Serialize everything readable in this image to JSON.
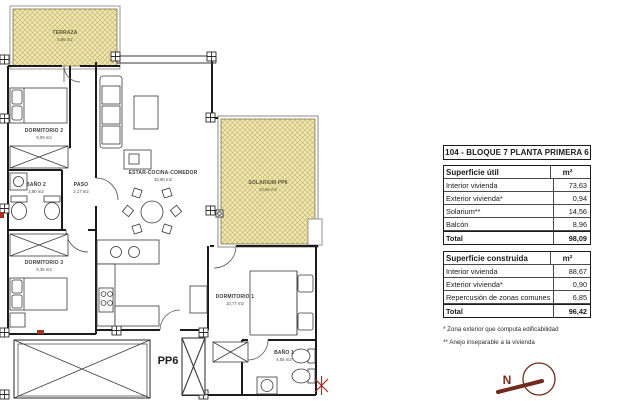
{
  "plan": {
    "rooms": {
      "terraza": {
        "name": "TERRAZA",
        "area": "8,96 m2"
      },
      "dormitorio2": {
        "name": "DORMITORIO 2",
        "area": "9,09 m2"
      },
      "bano2": {
        "name": "BAÑO 2",
        "area": "3,80 m2"
      },
      "paso": {
        "name": "PASO",
        "area": "2,17 m2"
      },
      "estar": {
        "name": "ESTAR-COCINA-COMEDOR",
        "area": "33,90 m2"
      },
      "solarium": {
        "name": "SOLARIUM PP6",
        "area": "14,56 m2"
      },
      "dormitorio3": {
        "name": "DORMITORIO 3",
        "area": "9,35 m2"
      },
      "dormitorio1": {
        "name": "DORMITORIO 1",
        "area": "10,77 m2"
      },
      "bano1": {
        "name": "BAÑO 1",
        "area": "4,55 m2"
      }
    },
    "unit_label": "PP6",
    "compass_north": "N"
  },
  "info": {
    "title": "104 - BLOQUE 7 PLANTA PRIMERA 6",
    "util": {
      "header": "Superficie útil",
      "unit": "m²",
      "rows": [
        [
          "Interior vivienda",
          "73,63"
        ],
        [
          "Exterior vivienda*",
          "0,94"
        ],
        [
          "Solarium**",
          "14,56"
        ],
        [
          "Balcón",
          "8,96"
        ]
      ],
      "total_label": "Total",
      "total_value": "98,09"
    },
    "construida": {
      "header": "Superficie construida",
      "unit": "m²",
      "rows": [
        [
          "Interior vivienda",
          "88,67"
        ],
        [
          "Exterior vivienda*",
          "0,90"
        ],
        [
          "Repercusión de zonas comunes",
          "6,85"
        ]
      ],
      "total_label": "Total",
      "total_value": "96,42"
    },
    "footnotes": [
      "* Zona exterior que computa edificabilidad",
      "** Anejo inseparable a la vivienda"
    ]
  },
  "colors": {
    "hatch_fill": "#eee8b0",
    "hatch_line": "#c3b169",
    "wall": "#1c1c1c",
    "compass": "#6f2b1b",
    "red_accent": "#b0291f"
  }
}
